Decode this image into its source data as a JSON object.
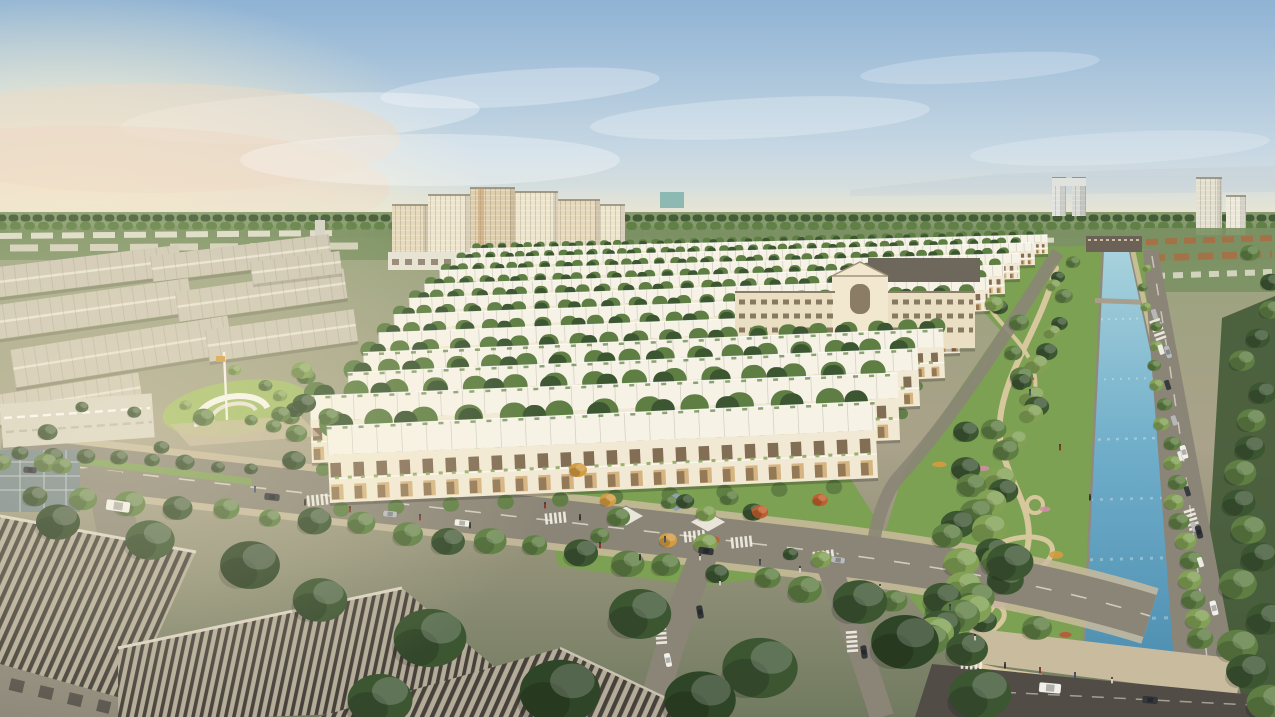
{
  "meta": {
    "alt": "Aerial rendering of a planned township: rows of white townhouses, cream apartment towers on the horizon, a long blue landscaped canal with linear parks on the right, tree-lined boulevards with cars and pedestrians, and large ribbed-roof industrial buildings in the left foreground under a warm hazy sky"
  },
  "colors": {
    "sky_top": "#8fb3d4",
    "sky_mid": "#c6d7e3",
    "sky_horizon": "#ece8d6",
    "sun_glow": "#fdf3cf",
    "cloud_warm": "#ecd9c6",
    "haze": "#ebe6d1",
    "ridge": "#c4cfd6",
    "ground_top": "#99a37d",
    "ground_mid": "#aaa28a",
    "ground_bottom": "#717a60",
    "distant_green": "#7b9163",
    "distant_building": "#e7e3d3",
    "tower_cream": "#eee5cd",
    "tower_cream2": "#e6d9bc",
    "tower_tan": "#dfcfae",
    "tower_accent": "#c49a66",
    "tower_teal": "#7fb2ab",
    "tower_grey": "#d4d2c6",
    "school_wall": "#eadfc2",
    "school_wall_light": "#f2e8cf",
    "school_roof": "#6e675c",
    "school_window": "#70604b",
    "townhouse_wall": "#f2e9d4",
    "townhouse_roof": "#f6f2e6",
    "townhouse_window": "#6f583f",
    "townhouse_glow": "#c99f5f",
    "industrial_roof": "#cdc6b3",
    "industrial_ridge": "#e8e2d1",
    "warehouse_roof_dark": "#46423b",
    "warehouse_roof_light": "#b4ab98",
    "warehouse_wall": "#8f897b",
    "glass_wall": "#77868a",
    "skylight_roof": "#d8d3c3",
    "road": "#8b8577",
    "road_dark": "#514d46",
    "road_line": "#f4f1e6",
    "sidewalk": "#c9bb9d",
    "grass": "#7da153",
    "grass_light": "#a4bd68",
    "park_path": "#dccaa2",
    "tree_dark": "#3d5632",
    "tree_mid": "#5e7e43",
    "tree_light": "#82a155",
    "tree_autumn": "#bf5f2e",
    "tree_yellow": "#d39c40",
    "canal_top": "#a9d3dd",
    "canal_mid": "#6fadc9",
    "canal_deep": "#4f90b2",
    "canal_edge": "#8f8a7d",
    "sand": "#d6c6a0",
    "flower_pink": "#cf8fa4",
    "flower_red": "#bd5738",
    "car_white": "#f1f0ea",
    "car_dark": "#34383d",
    "car_silver": "#b8bbbc",
    "people_dark": "#2f2b27",
    "villa_roof": "#b06a3f",
    "bridge": "#6b6156"
  }
}
